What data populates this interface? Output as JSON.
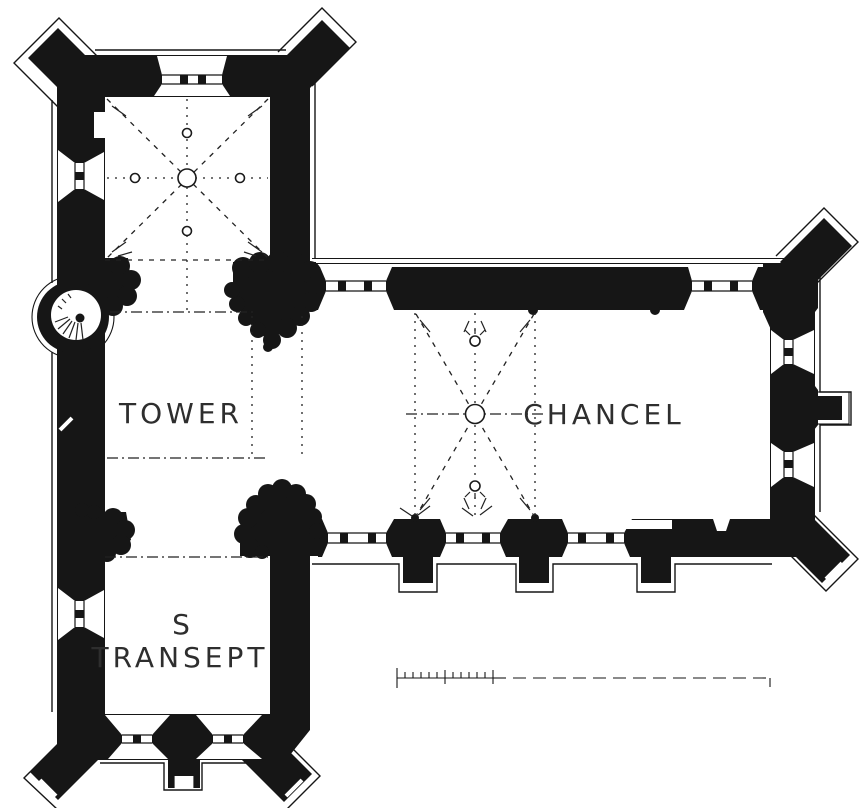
{
  "figure": {
    "kind": "church floor plan drawing",
    "orientation_note": "chancel to the east (right), tower at crossing, south transept below"
  },
  "labels": {
    "tower": "TOWER",
    "chancel": "CHANCEL",
    "south_transept_line1": "S",
    "south_transept_line2": "TRANSEPT"
  },
  "colors": {
    "ink": "#161616",
    "paper": "#ffffff"
  },
  "scale_bar": {
    "present": true,
    "numbers_visible": false,
    "small_divisions": 12,
    "style": "divided left section, long dashed extension to the right"
  }
}
